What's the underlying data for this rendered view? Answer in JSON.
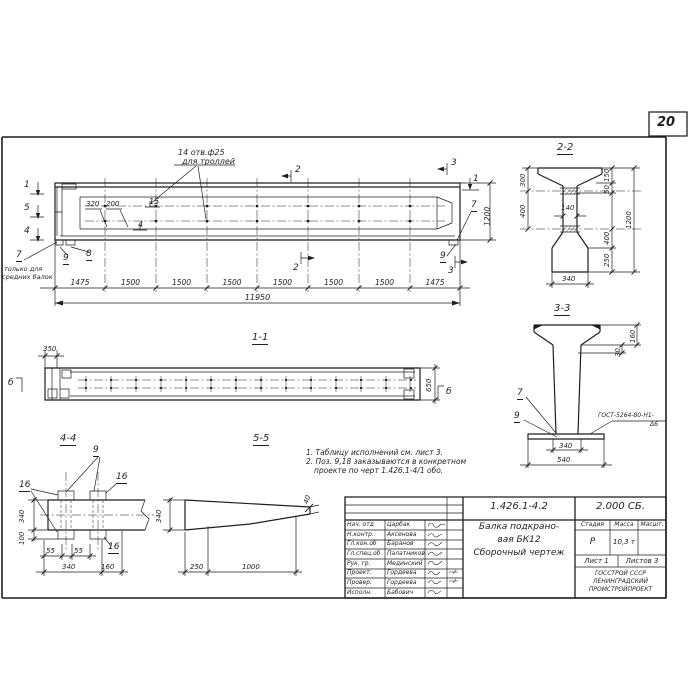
{
  "colors": {
    "ink": "#1f1f1f",
    "paper": "#ffffff"
  },
  "sheet": {
    "number": "20"
  },
  "elevation": {
    "hole_note1": "14 отв.ф25",
    "hole_note2": "для троллей",
    "m1": "1",
    "m5": "5",
    "m4": "4",
    "m2": "2",
    "m3": "3",
    "m1r": "1",
    "d320": "320",
    "d200": "200",
    "p15": "15",
    "p4": "4",
    "p7": "7",
    "p9": "9",
    "p8": "8",
    "p7r": "7",
    "p9r": "9",
    "note7_1": "только для",
    "note7_2": "средних балок",
    "d1200": "1200",
    "total": "11950",
    "dims": [
      "1475",
      "1500",
      "1500",
      "1500",
      "1500",
      "1500",
      "1500",
      "1475"
    ]
  },
  "s22": {
    "t": "2-2",
    "d300": "300",
    "d400": "400",
    "d150": "150",
    "d50": "50",
    "d1200": "1200",
    "d400b": "400",
    "d250": "250",
    "d140": "140",
    "d340": "340"
  },
  "s33": {
    "t": "3-3",
    "d160": "160",
    "d30": "30",
    "p7": "7",
    "p9": "9",
    "weld1": "ГОСТ-5264-80-Н1-",
    "weld2": "Δ6",
    "d340": "340",
    "d540": "540"
  },
  "s11": {
    "t": "1-1",
    "d350": "350",
    "d650": "650",
    "mb": "б"
  },
  "s44": {
    "t": "4-4",
    "p16": "16",
    "p9": "9",
    "d340": "340",
    "d100": "100",
    "d55": "55",
    "d340b": "340",
    "d160": "160"
  },
  "s55": {
    "t": "5-5",
    "d340": "340",
    "d40": "40",
    "d250": "250",
    "d1000": "1000"
  },
  "notes": {
    "n1": "1. Таблицу исполнений  см. лист 3.",
    "n2": "2. Поз. 9,18 заказываются в конкретном",
    "n3": "проекте по черт 1.426.1-4/1 обо."
  },
  "tb": {
    "num": "1.426.1-4.2",
    "code": "2.000 СБ.",
    "t1": "Балка подкрано-",
    "t2": "вая БК12",
    "t3": "Сборочный  чертеж",
    "h_stage": "Стадия",
    "h_mass": "Масса",
    "h_scale": "Масшт.",
    "stage": "Р",
    "mass": "10,3 т",
    "sheet": "Лист 1",
    "sheets": "Листов 3",
    "org1": "ГОССТРОЙ СССР",
    "org2": "ЛЕНИНГРАДСКИЙ",
    "org3": "ПРОМСТРОЙПРОЕКТ",
    "rows": [
      {
        "role": "Нач. отд",
        "name": "Царбак"
      },
      {
        "role": "Н.контр.",
        "name": "Аксенова"
      },
      {
        "role": "Гл.кон.об",
        "name": "Баранов"
      },
      {
        "role": "Гл.спец.об",
        "name": "Палатников"
      },
      {
        "role": "Рук. гр.",
        "name": "Мединский"
      },
      {
        "role": "Проект.",
        "name": "Гордеева"
      },
      {
        "role": "Провер.",
        "name": "Гордеева"
      },
      {
        "role": "Исполн.",
        "name": "Бабович"
      }
    ]
  }
}
